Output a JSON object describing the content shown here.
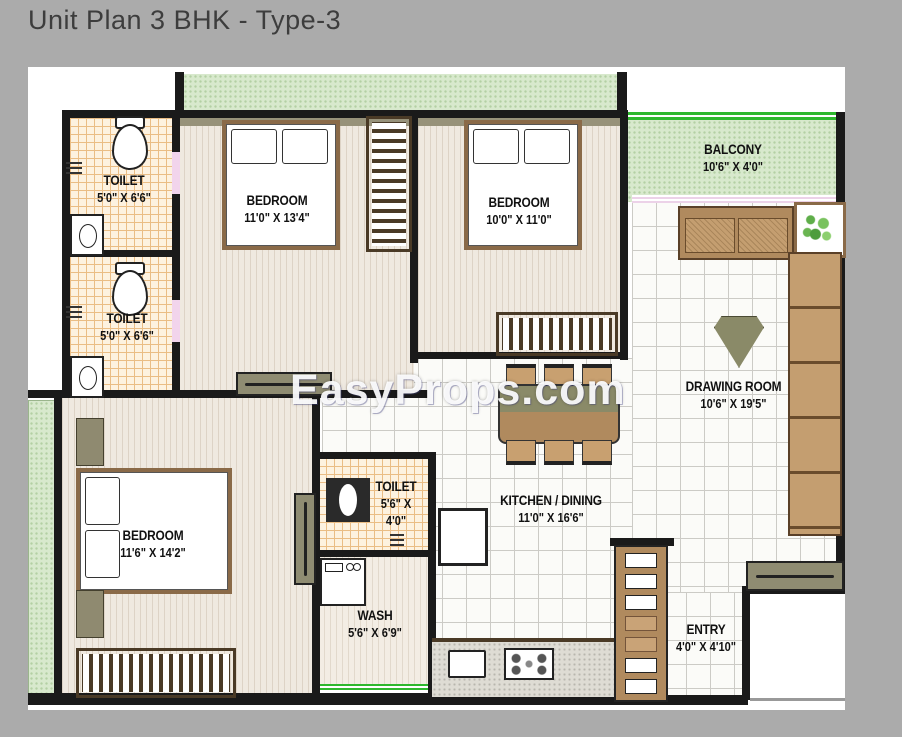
{
  "title": "Unit Plan 3 BHK - Type-3",
  "watermark": "EasyProps.com",
  "rooms": {
    "toilet_top": {
      "name": "TOILET",
      "size": "5'0\" X 6'6\""
    },
    "toilet_mid": {
      "name": "TOILET",
      "size": "5'0\" X 6'6\""
    },
    "bedroom_top_left": {
      "name": "BEDROOM",
      "size": "11'0\" X 13'4\""
    },
    "bedroom_top_right": {
      "name": "BEDROOM",
      "size": "10'0\" X 11'0\""
    },
    "balcony": {
      "name": "BALCONY",
      "size": "10'6\" X 4'0\""
    },
    "drawing_room": {
      "name": "DRAWING ROOM",
      "size": "10'6\" X 19'5\""
    },
    "bedroom_bottom": {
      "name": "BEDROOM",
      "size": "11'6\" X 14'2\""
    },
    "toilet_small": {
      "name": "TOILET",
      "size_line1": "5'6\" X",
      "size_line2": "4'0\""
    },
    "kitchen_dining": {
      "name": "KITCHEN / DINING",
      "size": "11'0\" X 16'6\""
    },
    "wash": {
      "name": "WASH",
      "size": "5'6\" X 6'9\""
    },
    "entry": {
      "name": "ENTRY",
      "size": "4'0\" X 4'10\""
    }
  },
  "colors": {
    "background_gray": "#ababab",
    "wall_black": "#1a1a1a",
    "balcony_green": "#d8e9cd",
    "railing_green": "#2eb82e",
    "toilet_tile_orange": "#eabd85",
    "floor_stripe_beige": "#efe9e0",
    "tile_grid_gray": "#cccbc6",
    "furniture_brown": "#b08a5e",
    "furniture_olive": "#8f8a70",
    "label_text": "#111111"
  }
}
